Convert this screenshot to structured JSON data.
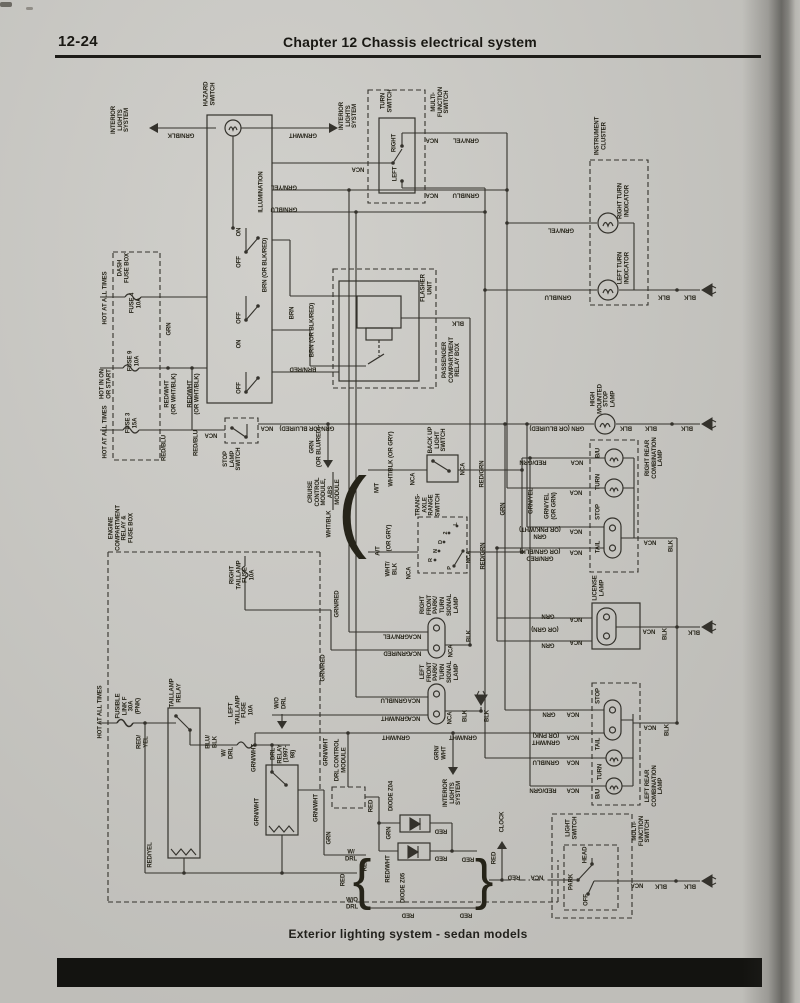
{
  "page": {
    "page_number": "12-24",
    "chapter_title": "Chapter 12   Chassis electrical system",
    "caption": "Exterior lighting system - sedan models"
  },
  "diagram": {
    "labels": [
      {
        "t": "INTERIOR\nLIGHTS\nSYSTEM",
        "x": 121,
        "y": 120,
        "r": 90
      },
      {
        "t": "GRN/BLK",
        "x": 181,
        "y": 134,
        "r": 180
      },
      {
        "t": "HAZARD\nSWITCH",
        "x": 210,
        "y": 94,
        "r": 90
      },
      {
        "t": "ILLUMINATION",
        "x": 262,
        "y": 192,
        "r": 90
      },
      {
        "t": "GRN/WHT",
        "x": 303,
        "y": 134,
        "r": 180
      },
      {
        "t": "INTERIOR\nLIGHTS\nSYSTEM",
        "x": 349,
        "y": 116,
        "r": 90
      },
      {
        "t": "NCA",
        "x": 358,
        "y": 168,
        "r": 180
      },
      {
        "t": "TURN\nSWITCH",
        "x": 387,
        "y": 101,
        "r": 90
      },
      {
        "t": "MULTI-\nFUNCTION\nSWITCH",
        "x": 441,
        "y": 102,
        "r": 90
      },
      {
        "t": "RIGHT",
        "x": 395,
        "y": 143,
        "r": 90
      },
      {
        "t": "LEFT",
        "x": 396,
        "y": 174,
        "r": 90
      },
      {
        "t": "NCA",
        "x": 432,
        "y": 139,
        "r": 180
      },
      {
        "t": "GRN/YEL",
        "x": 466,
        "y": 139,
        "r": 180
      },
      {
        "t": "NCA",
        "x": 432,
        "y": 194,
        "r": 180
      },
      {
        "t": "GRN/BLU",
        "x": 466,
        "y": 194,
        "r": 180
      },
      {
        "t": "INSTRUMENT\nCLUSTER",
        "x": 601,
        "y": 136,
        "r": 90
      },
      {
        "t": "RIGHT TURN\nINDICATOR",
        "x": 624,
        "y": 201,
        "r": 90
      },
      {
        "t": "LEFT TURN\nINDICATOR",
        "x": 624,
        "y": 268,
        "r": 90
      },
      {
        "t": "GRN/YEL",
        "x": 561,
        "y": 229,
        "r": 180
      },
      {
        "t": "GRN/BLU",
        "x": 558,
        "y": 296,
        "r": 180
      },
      {
        "t": "BLK",
        "x": 664,
        "y": 296,
        "r": 180
      },
      {
        "t": "BLK",
        "x": 690,
        "y": 296,
        "r": 180
      },
      {
        "t": "HOT AT ALL TIMES",
        "x": 106,
        "y": 298,
        "r": 90
      },
      {
        "t": "DASH\nFUSE BOX",
        "x": 124,
        "y": 268,
        "r": 90
      },
      {
        "t": "FUSE 4\n10A",
        "x": 136,
        "y": 303,
        "r": 90
      },
      {
        "t": "GRN",
        "x": 170,
        "y": 329,
        "r": 90
      },
      {
        "t": "HOT IN ON\nOR START",
        "x": 106,
        "y": 384,
        "r": 90
      },
      {
        "t": "FUSE 9\n10A",
        "x": 134,
        "y": 361,
        "r": 90
      },
      {
        "t": "RED/WHT\n(OR WHT/BLK)",
        "x": 171,
        "y": 394,
        "r": 90
      },
      {
        "t": "RED/WHT\n(OR WHT/BLK)",
        "x": 194,
        "y": 394,
        "r": 90
      },
      {
        "t": "HOT AT ALL TIMES",
        "x": 106,
        "y": 432,
        "r": 90
      },
      {
        "t": "FUSE 3\n15A",
        "x": 132,
        "y": 423,
        "r": 90
      },
      {
        "t": "RED/BLU",
        "x": 165,
        "y": 448,
        "r": 90
      },
      {
        "t": "RED/BLU",
        "x": 197,
        "y": 443,
        "r": 90
      },
      {
        "t": "ON",
        "x": 240,
        "y": 232,
        "r": 90
      },
      {
        "t": "OFF",
        "x": 240,
        "y": 262,
        "r": 90
      },
      {
        "t": "OFF",
        "x": 240,
        "y": 318,
        "r": 90
      },
      {
        "t": "ON",
        "x": 240,
        "y": 344,
        "r": 90
      },
      {
        "t": "OFF",
        "x": 240,
        "y": 388,
        "r": 90
      },
      {
        "t": "GRN/YEL",
        "x": 284,
        "y": 186,
        "r": 180
      },
      {
        "t": "GRN/BLU",
        "x": 284,
        "y": 208,
        "r": 180
      },
      {
        "t": "BRN (OR BLK/RED)",
        "x": 266,
        "y": 265,
        "r": 90
      },
      {
        "t": "BRN",
        "x": 293,
        "y": 313,
        "r": 90
      },
      {
        "t": "BRN (OR BLK/RED)",
        "x": 313,
        "y": 330,
        "r": 90
      },
      {
        "t": "BRN/RED",
        "x": 303,
        "y": 368,
        "r": 180
      },
      {
        "t": "FLASHER\nUNIT",
        "x": 427,
        "y": 288,
        "r": 90
      },
      {
        "t": "PASSENGER\nCOMPARTMENT\nRELAY BOX",
        "x": 452,
        "y": 360,
        "r": 90
      },
      {
        "t": "BLK",
        "x": 458,
        "y": 322,
        "r": 180
      },
      {
        "t": "NCA",
        "x": 211,
        "y": 434,
        "r": 180
      },
      {
        "t": "STOP\nLAMP\nSWITCH",
        "x": 233,
        "y": 459,
        "r": 90
      },
      {
        "t": "NCA",
        "x": 267,
        "y": 427,
        "r": 180
      },
      {
        "t": "GRN (OR BLU/RED)",
        "x": 307,
        "y": 427,
        "r": 180
      },
      {
        "t": "GRN\n(OR BLU/RED)",
        "x": 316,
        "y": 447,
        "r": 90
      },
      {
        "t": "CRUISE\nCONTROL\nMODULE,\nABS\nMODULE",
        "x": 325,
        "y": 492,
        "r": 90
      },
      {
        "t": "WHT/BLK",
        "x": 330,
        "y": 524,
        "r": 90
      },
      {
        "t": "M/T",
        "x": 378,
        "y": 488,
        "r": 90
      },
      {
        "t": "WHT/BLK (OR GRY)",
        "x": 392,
        "y": 459,
        "r": 90
      },
      {
        "t": "NCA",
        "x": 414,
        "y": 479,
        "r": 90
      },
      {
        "t": "BACK UP\nLIGHT\nSWITCH",
        "x": 438,
        "y": 440,
        "r": 90
      },
      {
        "t": "NCA",
        "x": 464,
        "y": 469,
        "r": 90
      },
      {
        "t": "RED/GRN",
        "x": 483,
        "y": 474,
        "r": 90
      },
      {
        "t": "A/T",
        "x": 379,
        "y": 551,
        "r": 90
      },
      {
        "t": "(OR GRY)",
        "x": 390,
        "y": 538,
        "r": 90
      },
      {
        "t": "WHT/\nBLK",
        "x": 392,
        "y": 569,
        "r": 90
      },
      {
        "t": "NCA",
        "x": 410,
        "y": 573,
        "r": 90
      },
      {
        "t": "TRANS-\nAXLE\nRANGE\nSWITCH",
        "x": 429,
        "y": 505,
        "r": 90
      },
      {
        "t": "R",
        "x": 431,
        "y": 560,
        "r": 90,
        "fs": 5.5
      },
      {
        "t": "N",
        "x": 436,
        "y": 551,
        "r": 90,
        "fs": 5.5
      },
      {
        "t": "D",
        "x": 441,
        "y": 542,
        "r": 90,
        "fs": 5.5
      },
      {
        "t": "2",
        "x": 446,
        "y": 533,
        "r": 90,
        "fs": 5.5
      },
      {
        "t": "L",
        "x": 456,
        "y": 524,
        "r": 90,
        "fs": 5.5
      },
      {
        "t": "P",
        "x": 450,
        "y": 568,
        "r": 90,
        "fs": 5.5
      },
      {
        "t": "NCA",
        "x": 470,
        "y": 557,
        "r": 90
      },
      {
        "t": "RED/GRN",
        "x": 484,
        "y": 556,
        "r": 90
      },
      {
        "t": "GRN",
        "x": 504,
        "y": 509,
        "r": 90
      },
      {
        "t": "HIGH\nMOUNTED\nSTOP\nLAMP",
        "x": 604,
        "y": 399,
        "r": 90
      },
      {
        "t": "GRN (OR BLU/RED)",
        "x": 557,
        "y": 427,
        "r": 180
      },
      {
        "t": "BLK",
        "x": 626,
        "y": 427,
        "r": 180
      },
      {
        "t": "BLK",
        "x": 651,
        "y": 427,
        "r": 180
      },
      {
        "t": "BLK",
        "x": 687,
        "y": 427,
        "r": 180
      },
      {
        "t": "RIGHT REAR\nCOMBINATION\nLAMP",
        "x": 655,
        "y": 458,
        "r": 90
      },
      {
        "t": "B/U",
        "x": 599,
        "y": 453,
        "r": 90
      },
      {
        "t": "TURN",
        "x": 599,
        "y": 482,
        "r": 90
      },
      {
        "t": "STOP",
        "x": 599,
        "y": 512,
        "r": 90
      },
      {
        "t": "TAIL",
        "x": 599,
        "y": 547,
        "r": 90
      },
      {
        "t": "RED/GRN",
        "x": 533,
        "y": 461,
        "r": 180
      },
      {
        "t": "NCA",
        "x": 577,
        "y": 461,
        "r": 180
      },
      {
        "t": "NCA",
        "x": 576,
        "y": 491,
        "r": 180
      },
      {
        "t": "GRN/YEL",
        "x": 532,
        "y": 501,
        "r": 90
      },
      {
        "t": "GRN/YEL\n(OR GRN)",
        "x": 551,
        "y": 506,
        "r": 90
      },
      {
        "t": "NCA",
        "x": 576,
        "y": 530,
        "r": 180
      },
      {
        "t": "GRN\n(OR PNK/WHT)",
        "x": 540,
        "y": 532,
        "r": 180
      },
      {
        "t": "NCA",
        "x": 576,
        "y": 551,
        "r": 180
      },
      {
        "t": "GRN/RED\n(OR GRN/BLK)",
        "x": 540,
        "y": 554,
        "r": 180
      },
      {
        "t": "NCA",
        "x": 650,
        "y": 541,
        "r": 180
      },
      {
        "t": "BLK",
        "x": 672,
        "y": 546,
        "r": 90
      },
      {
        "t": "LICENSE\nLAMP",
        "x": 599,
        "y": 588,
        "r": 90
      },
      {
        "t": "GRN",
        "x": 548,
        "y": 615,
        "r": 180
      },
      {
        "t": "(OR GRN)",
        "x": 545,
        "y": 628,
        "r": 180
      },
      {
        "t": "GRN",
        "x": 548,
        "y": 644,
        "r": 180
      },
      {
        "t": "NCA",
        "x": 576,
        "y": 618,
        "r": 180
      },
      {
        "t": "NCA",
        "x": 576,
        "y": 641,
        "r": 180
      },
      {
        "t": "NCA",
        "x": 649,
        "y": 630,
        "r": 180
      },
      {
        "t": "BLK",
        "x": 666,
        "y": 634,
        "r": 90
      },
      {
        "t": "BLK",
        "x": 694,
        "y": 631,
        "r": 180
      },
      {
        "t": "ENGINE\nCOMPARTMENT\nRELAY &\nFUSE BOX",
        "x": 122,
        "y": 528,
        "r": 90
      },
      {
        "t": "RIGHT\nTAILLAMP\nFUSE\n10A",
        "x": 243,
        "y": 575,
        "r": 90
      },
      {
        "t": "GRN/RED",
        "x": 338,
        "y": 604,
        "r": 90
      },
      {
        "t": "GRN/RED",
        "x": 324,
        "y": 668,
        "r": 90
      },
      {
        "t": "RIGHT\nFRONT\nPARK/\nTURN\nSIGNAL\nLAMP",
        "x": 440,
        "y": 605,
        "r": 90
      },
      {
        "t": "GRN/YEL",
        "x": 396,
        "y": 635,
        "r": 180
      },
      {
        "t": "NCA",
        "x": 415,
        "y": 635,
        "r": 180
      },
      {
        "t": "GRN/RED",
        "x": 397,
        "y": 652,
        "r": 180
      },
      {
        "t": "NCA",
        "x": 415,
        "y": 652,
        "r": 180
      },
      {
        "t": "NCA",
        "x": 452,
        "y": 651,
        "r": 90
      },
      {
        "t": "BLK",
        "x": 470,
        "y": 636,
        "r": 90
      },
      {
        "t": "LEFT\nFRONT\nPARK/\nTURN\nSIGNAL\nLAMP",
        "x": 440,
        "y": 672,
        "r": 90
      },
      {
        "t": "GRN/BLU",
        "x": 394,
        "y": 699,
        "r": 180
      },
      {
        "t": "NCA",
        "x": 414,
        "y": 699,
        "r": 180
      },
      {
        "t": "GRN/WHT",
        "x": 395,
        "y": 717,
        "r": 180
      },
      {
        "t": "NCA",
        "x": 414,
        "y": 717,
        "r": 180
      },
      {
        "t": "NCA",
        "x": 451,
        "y": 718,
        "r": 90
      },
      {
        "t": "BLK",
        "x": 466,
        "y": 716,
        "r": 90
      },
      {
        "t": "BLK",
        "x": 488,
        "y": 716,
        "r": 90
      },
      {
        "t": "HOT AT ALL TIMES",
        "x": 101,
        "y": 712,
        "r": 90
      },
      {
        "t": "FUSIBLE\nLINK F\n30A\n(PNK)",
        "x": 129,
        "y": 706,
        "r": 90
      },
      {
        "t": "RED/\nYEL",
        "x": 143,
        "y": 742,
        "r": 90
      },
      {
        "t": "TAILLAMP\nRELAY",
        "x": 176,
        "y": 693,
        "r": 90
      },
      {
        "t": "BLU/\nBLK",
        "x": 212,
        "y": 742,
        "r": 90
      },
      {
        "t": "LEFT\nTAILLAMP\nFUSE\n10A",
        "x": 242,
        "y": 710,
        "r": 90
      },
      {
        "t": "W/\nDRL",
        "x": 228,
        "y": 753,
        "r": 90
      },
      {
        "t": "GRN/WHT",
        "x": 255,
        "y": 758,
        "r": 90
      },
      {
        "t": "W/O\nDRL",
        "x": 281,
        "y": 703,
        "r": 90
      },
      {
        "t": "DRL\nRELAY\n(1997-\n98)",
        "x": 284,
        "y": 754,
        "r": 90
      },
      {
        "t": "GRN/WHT",
        "x": 327,
        "y": 752,
        "r": 90
      },
      {
        "t": "GRN/WHT",
        "x": 258,
        "y": 812,
        "r": 90
      },
      {
        "t": "GRN/WHT",
        "x": 317,
        "y": 808,
        "r": 90
      },
      {
        "t": "GRN",
        "x": 330,
        "y": 838,
        "r": 90
      },
      {
        "t": "RED/YEL",
        "x": 151,
        "y": 855,
        "r": 90
      },
      {
        "t": "W/\nDRL",
        "x": 351,
        "y": 856,
        "r": 0
      },
      {
        "t": "RED",
        "x": 344,
        "y": 880,
        "r": 90
      },
      {
        "t": "W/O\nDRL",
        "x": 352,
        "y": 904,
        "r": 0
      },
      {
        "t": "DRL CONTROL\nMODULE",
        "x": 341,
        "y": 760,
        "r": 90
      },
      {
        "t": "GRN/WHT",
        "x": 396,
        "y": 736,
        "r": 180
      },
      {
        "t": "GRN/WHT",
        "x": 463,
        "y": 736,
        "r": 180
      },
      {
        "t": "GRN/\nWHT",
        "x": 441,
        "y": 753,
        "r": 90
      },
      {
        "t": "INTERIOR\nLIGHTS\nSYSTEM",
        "x": 453,
        "y": 793,
        "r": 90
      },
      {
        "t": "RED",
        "x": 372,
        "y": 806,
        "r": 90
      },
      {
        "t": "DIODE Z04",
        "x": 392,
        "y": 796,
        "r": 90
      },
      {
        "t": "GRN",
        "x": 390,
        "y": 833,
        "r": 90
      },
      {
        "t": "RED",
        "x": 441,
        "y": 830,
        "r": 180
      },
      {
        "t": "RED",
        "x": 366,
        "y": 865,
        "r": 90
      },
      {
        "t": "RED/WHT",
        "x": 389,
        "y": 869,
        "r": 90
      },
      {
        "t": "DIODE Z05",
        "x": 404,
        "y": 888,
        "r": 90
      },
      {
        "t": "RED",
        "x": 441,
        "y": 857,
        "r": 180
      },
      {
        "t": "RED",
        "x": 468,
        "y": 858,
        "r": 180
      },
      {
        "t": "RED",
        "x": 408,
        "y": 914,
        "r": 180
      },
      {
        "t": "RED",
        "x": 466,
        "y": 914,
        "r": 180
      },
      {
        "t": "RED",
        "x": 495,
        "y": 858,
        "r": 90
      },
      {
        "t": "CLOCK",
        "x": 503,
        "y": 822,
        "r": 90
      },
      {
        "t": "RED",
        "x": 514,
        "y": 876,
        "r": 180
      },
      {
        "t": "NCA",
        "x": 537,
        "y": 876,
        "r": 180
      },
      {
        "t": "LIGHT\nSWITCH",
        "x": 572,
        "y": 828,
        "r": 90
      },
      {
        "t": "MULTI-\nFUNCTION\nSWITCH",
        "x": 642,
        "y": 831,
        "r": 90
      },
      {
        "t": "HEAD",
        "x": 586,
        "y": 855,
        "r": 90
      },
      {
        "t": "PARK",
        "x": 572,
        "y": 882,
        "r": 90
      },
      {
        "t": "OFF",
        "x": 587,
        "y": 900,
        "r": 90
      },
      {
        "t": "NCA",
        "x": 637,
        "y": 884,
        "r": 180
      },
      {
        "t": "BLK",
        "x": 661,
        "y": 885,
        "r": 180
      },
      {
        "t": "BLK",
        "x": 690,
        "y": 885,
        "r": 180
      },
      {
        "t": "LEFT REAR\nCOMBINATION\nLAMP",
        "x": 655,
        "y": 786,
        "r": 90
      },
      {
        "t": "STOP",
        "x": 599,
        "y": 696,
        "r": 90
      },
      {
        "t": "TAIL",
        "x": 599,
        "y": 744,
        "r": 90
      },
      {
        "t": "TURN",
        "x": 601,
        "y": 772,
        "r": 90
      },
      {
        "t": "B/U",
        "x": 599,
        "y": 794,
        "r": 90
      },
      {
        "t": "GRN",
        "x": 549,
        "y": 713,
        "r": 180
      },
      {
        "t": "NCA",
        "x": 573,
        "y": 713,
        "r": 180
      },
      {
        "t": "GRN/WHT\n(OR PNK)",
        "x": 546,
        "y": 738,
        "r": 180
      },
      {
        "t": "NCA",
        "x": 573,
        "y": 736,
        "r": 180
      },
      {
        "t": "GRN/BLU",
        "x": 546,
        "y": 761,
        "r": 180
      },
      {
        "t": "NCA",
        "x": 573,
        "y": 761,
        "r": 180
      },
      {
        "t": "RED/GRN",
        "x": 543,
        "y": 789,
        "r": 180
      },
      {
        "t": "NCA",
        "x": 573,
        "y": 789,
        "r": 180
      },
      {
        "t": "NCA",
        "x": 650,
        "y": 726,
        "r": 180
      },
      {
        "t": "BLK",
        "x": 668,
        "y": 730,
        "r": 90
      },
      {
        "t": "{",
        "x": 362,
        "y": 880,
        "r": 0,
        "fs": 56,
        "fw": 400
      },
      {
        "t": "}",
        "x": 484,
        "y": 880,
        "r": 0,
        "fs": 56,
        "fw": 400
      },
      {
        "t": "(",
        "x": 352,
        "y": 511,
        "r": 0,
        "fs": 90,
        "fw": 400
      }
    ]
  }
}
